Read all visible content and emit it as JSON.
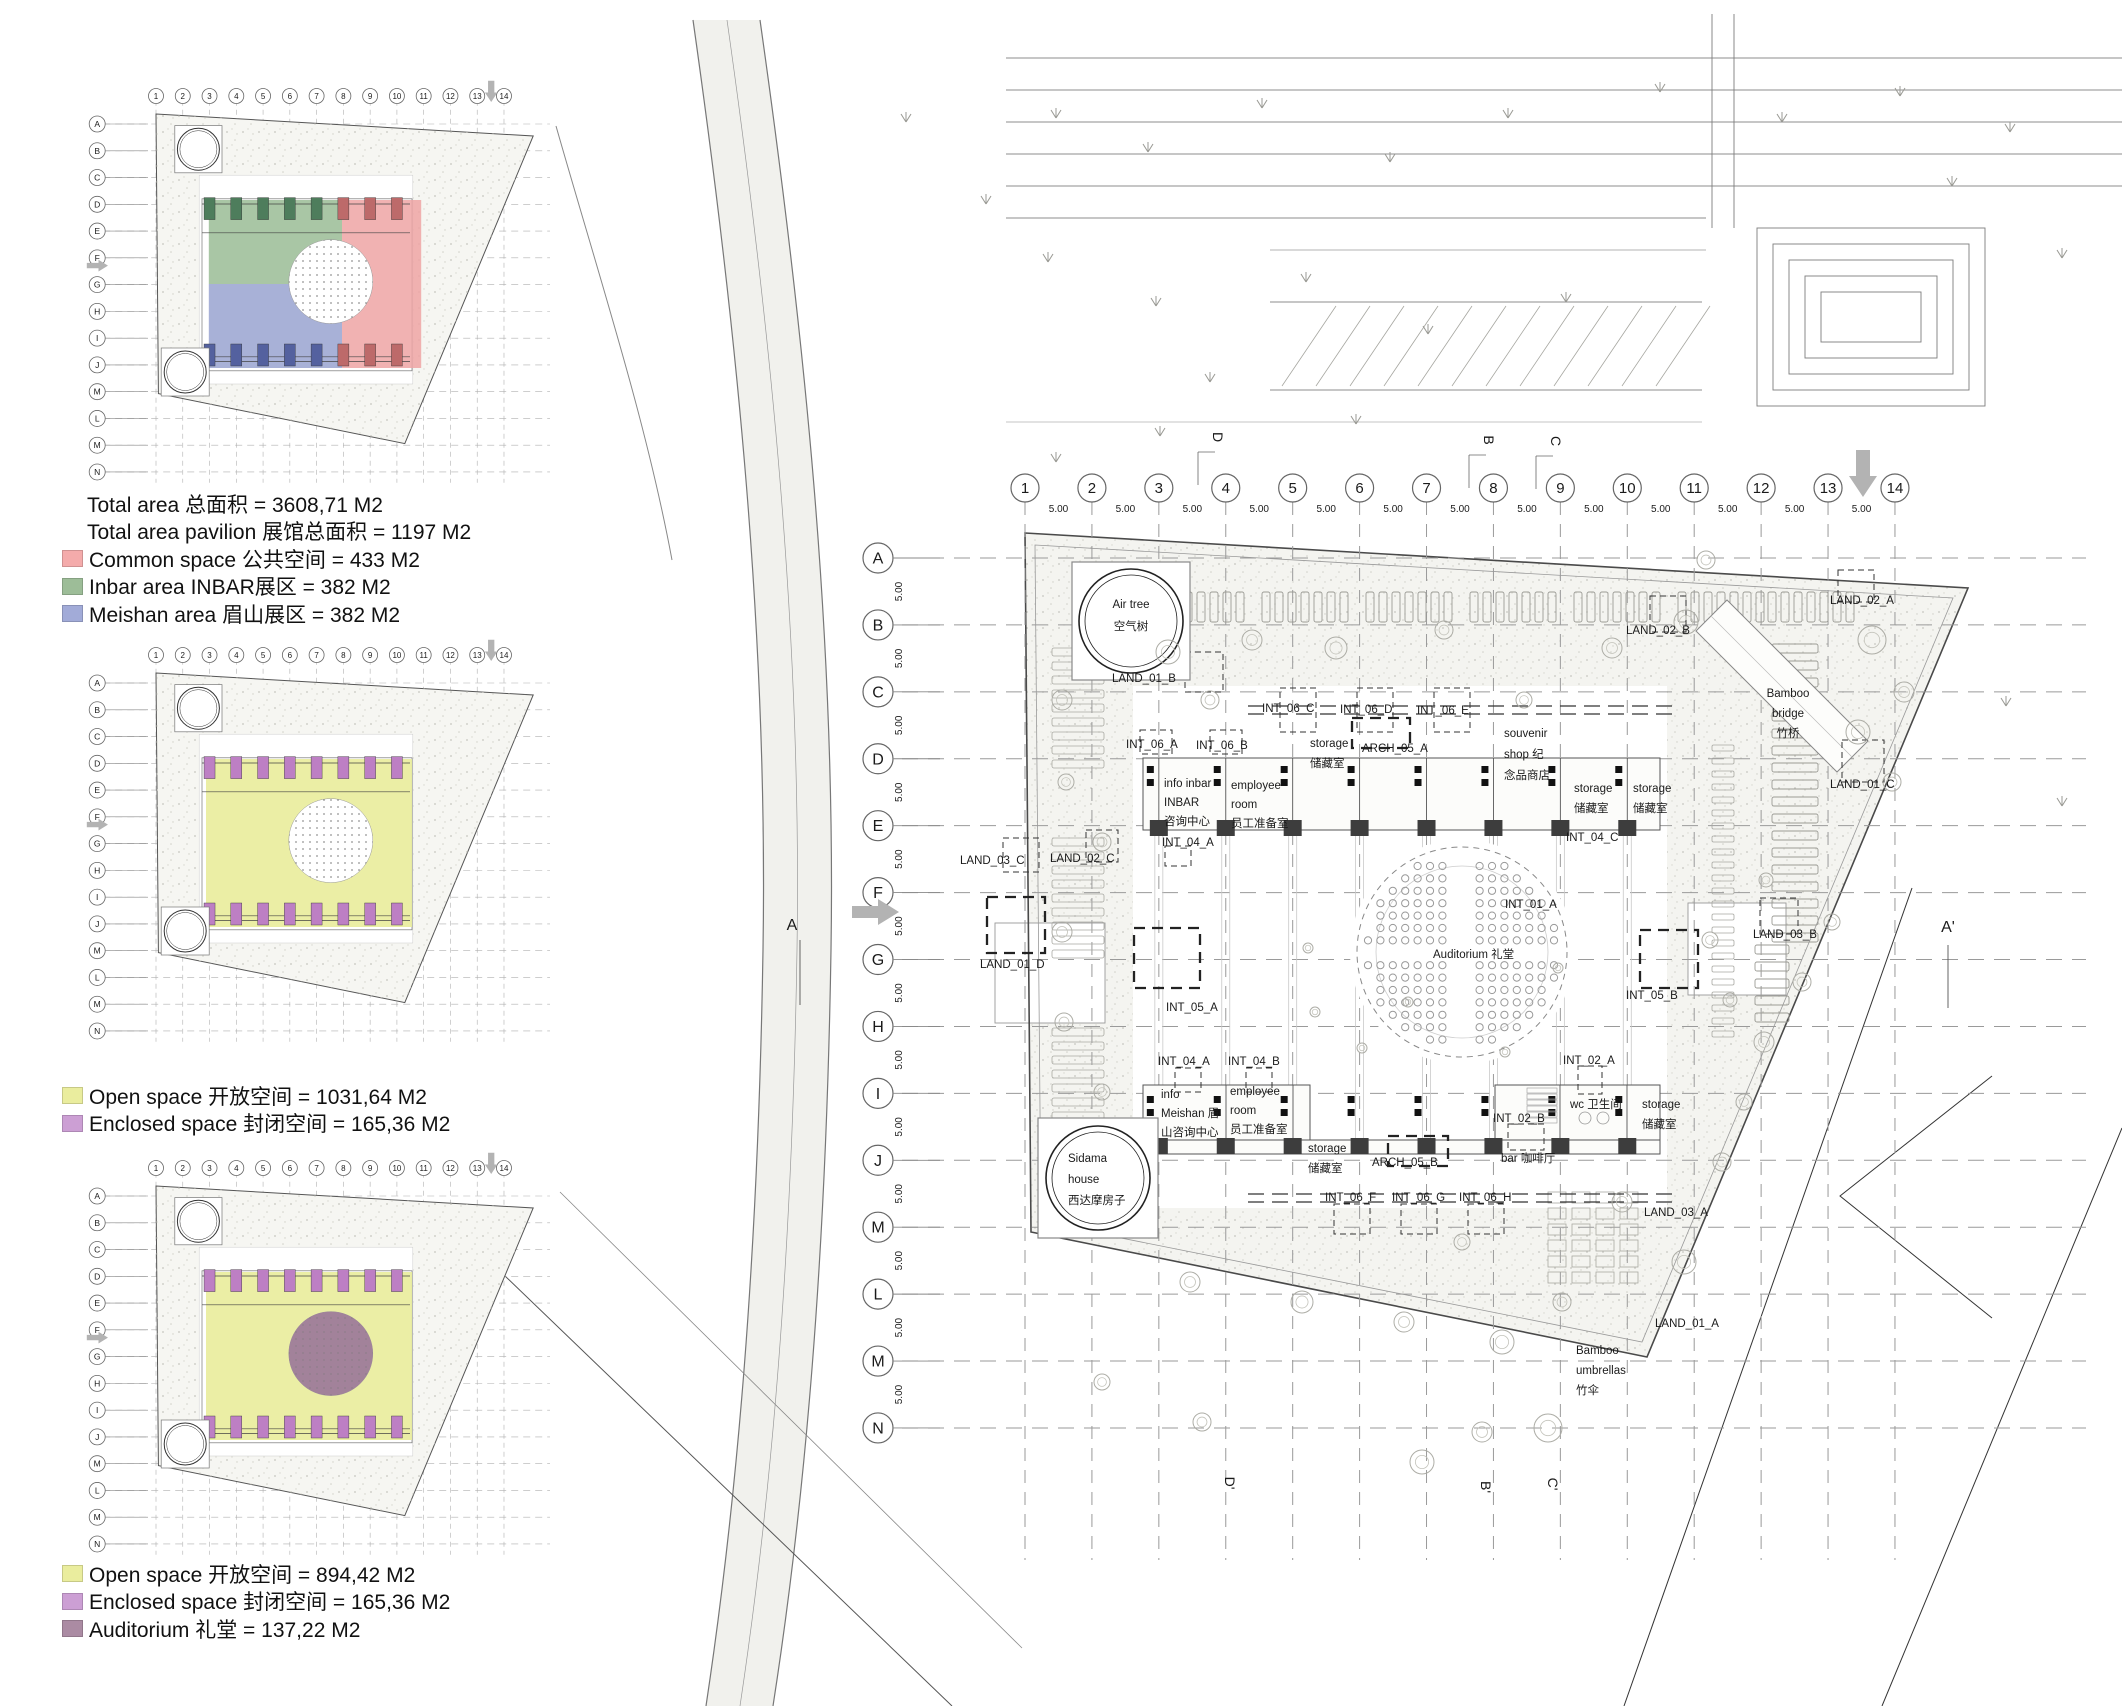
{
  "colors": {
    "common_pink": "#efa5a4",
    "inbar_green": "#9abc95",
    "meishan_blue": "#99a3d0",
    "open_yellow": "#e9ec9b",
    "enclosed_purple": "#bd7fc4",
    "auditorium_mauve": "#9d7b95",
    "swatch_pink": "#f4abab",
    "swatch_green": "#9dbd98",
    "swatch_blue": "#a2abd8",
    "swatch_yellow": "#eaed9e",
    "swatch_purple": "#cc9fd4",
    "swatch_mauve": "#ab8ba3",
    "road_gray": "#f1f1ed",
    "arrow_gray": "#b3b3b3"
  },
  "legends": [
    {
      "rows": [
        {
          "swatch": null,
          "text": "Total area 总面积 = 3608,71 M2"
        },
        {
          "swatch": null,
          "text": "Total area pavilion 展馆总面积 = 1197 M2"
        },
        {
          "swatch": "swatch_pink",
          "text": "Common space 公共空间 = 433 M2"
        },
        {
          "swatch": "swatch_green",
          "text": "Inbar area  INBAR展区 = 382 M2"
        },
        {
          "swatch": "swatch_blue",
          "text": "Meishan area 眉山展区 = 382 M2"
        }
      ]
    },
    {
      "rows": [
        {
          "swatch": "swatch_yellow",
          "text": "Open space 开放空间 = 1031,64 M2"
        },
        {
          "swatch": "swatch_purple",
          "text": "Enclosed space 封闭空间 = 165,36 M2"
        }
      ]
    },
    {
      "rows": [
        {
          "swatch": "swatch_yellow",
          "text": "Open space 开放空间 = 894,42 M2"
        },
        {
          "swatch": "swatch_purple",
          "text": "Enclosed space 封闭空间 = 165,36 M2"
        },
        {
          "swatch": "swatch_mauve",
          "text": "Auditorium 礼堂 = 137,22 M2"
        }
      ]
    }
  ],
  "grid": {
    "columns": [
      "1",
      "2",
      "3",
      "4",
      "5",
      "6",
      "7",
      "8",
      "9",
      "10",
      "11",
      "12",
      "13",
      "14"
    ],
    "rows": [
      "A",
      "B",
      "C",
      "D",
      "E",
      "F",
      "G",
      "H",
      "I",
      "J",
      "M",
      "L",
      "M",
      "N"
    ],
    "spacing_label": "5.00"
  },
  "section_markers": {
    "top": [
      "D",
      "B",
      "C"
    ],
    "bottom": [
      "D'",
      "B'",
      "C'"
    ],
    "left": "A",
    "right": "A'"
  },
  "plan_labels": [
    {
      "x": 1131,
      "y": 608,
      "a": "m",
      "lines": [
        "Air tree",
        "空气树"
      ],
      "lh": 22
    },
    {
      "x": 1112,
      "y": 682,
      "lines": [
        "LAND_01_B"
      ]
    },
    {
      "x": 1626,
      "y": 634,
      "lines": [
        "LAND_02_B"
      ]
    },
    {
      "x": 1830,
      "y": 604,
      "lines": [
        "LAND_02_A"
      ]
    },
    {
      "x": 1788,
      "y": 697,
      "a": "m",
      "lines": [
        "Bamboo",
        "bridge",
        "竹桥"
      ],
      "lh": 20
    },
    {
      "x": 1830,
      "y": 788,
      "lines": [
        "LAND_01_C"
      ]
    },
    {
      "x": 1262,
      "y": 712,
      "lines": [
        "INT_06_C"
      ]
    },
    {
      "x": 1340,
      "y": 713,
      "lines": [
        "INT_06_D"
      ]
    },
    {
      "x": 1417,
      "y": 714,
      "lines": [
        "INT_06_E"
      ]
    },
    {
      "x": 1126,
      "y": 748,
      "lines": [
        "INT_06_A"
      ]
    },
    {
      "x": 1196,
      "y": 749,
      "lines": [
        "INT_06_B"
      ]
    },
    {
      "x": 1310,
      "y": 747,
      "lines": [
        "storage",
        "储藏室"
      ],
      "lh": 20
    },
    {
      "x": 1362,
      "y": 752,
      "lines": [
        "ARCH_05_A"
      ]
    },
    {
      "x": 1504,
      "y": 737,
      "lines": [
        "souvenir",
        "shop 纪",
        "念品商店"
      ],
      "lh": 21
    },
    {
      "x": 1164,
      "y": 787,
      "lines": [
        "info inbar",
        "INBAR",
        "咨询中心"
      ],
      "lh": 19
    },
    {
      "x": 1231,
      "y": 789,
      "lines": [
        "employee",
        "room",
        "员工准备室"
      ],
      "lh": 19
    },
    {
      "x": 1162,
      "y": 846,
      "lines": [
        "INT_04_A"
      ]
    },
    {
      "x": 1574,
      "y": 792,
      "lines": [
        "storage",
        "储藏室"
      ],
      "lh": 20
    },
    {
      "x": 1633,
      "y": 792,
      "lines": [
        "storage",
        "储藏室"
      ],
      "lh": 20
    },
    {
      "x": 1566,
      "y": 841,
      "lines": [
        "INT_04_C"
      ]
    },
    {
      "x": 960,
      "y": 864,
      "lines": [
        "LAND_03_C"
      ]
    },
    {
      "x": 1050,
      "y": 862,
      "lines": [
        "LAND_02_C"
      ]
    },
    {
      "x": 980,
      "y": 968,
      "lines": [
        "LAND_01_D"
      ]
    },
    {
      "x": 1166,
      "y": 1011,
      "lines": [
        "INT_05_A"
      ]
    },
    {
      "x": 1505,
      "y": 908,
      "lines": [
        "INT_01_A"
      ]
    },
    {
      "x": 1433,
      "y": 958,
      "lines": [
        "Auditorium 礼堂"
      ]
    },
    {
      "x": 1626,
      "y": 999,
      "lines": [
        "INT_05_B"
      ]
    },
    {
      "x": 1753,
      "y": 938,
      "lines": [
        "LAND_03_B"
      ]
    },
    {
      "x": 1158,
      "y": 1065,
      "lines": [
        "INT_04_A"
      ]
    },
    {
      "x": 1228,
      "y": 1065,
      "lines": [
        "INT_04_B"
      ]
    },
    {
      "x": 1161,
      "y": 1098,
      "lines": [
        "info",
        "Meishan 眉",
        "山咨询中心"
      ],
      "lh": 19
    },
    {
      "x": 1230,
      "y": 1095,
      "lines": [
        "employee",
        "room",
        "员工准备室"
      ],
      "lh": 19
    },
    {
      "x": 1308,
      "y": 1152,
      "lines": [
        "storage",
        "储藏室"
      ],
      "lh": 20
    },
    {
      "x": 1372,
      "y": 1166,
      "lines": [
        "ARCH_05_B"
      ]
    },
    {
      "x": 1493,
      "y": 1122,
      "lines": [
        "INT_02_B"
      ]
    },
    {
      "x": 1501,
      "y": 1162,
      "lines": [
        "bar 咖啡厅"
      ]
    },
    {
      "x": 1325,
      "y": 1201,
      "lines": [
        "INT_06_F"
      ]
    },
    {
      "x": 1392,
      "y": 1201,
      "lines": [
        "INT_06_G"
      ]
    },
    {
      "x": 1459,
      "y": 1201,
      "lines": [
        "INT_06_H"
      ]
    },
    {
      "x": 1563,
      "y": 1064,
      "lines": [
        "INT_02_A"
      ]
    },
    {
      "x": 1570,
      "y": 1108,
      "lines": [
        "wc 卫生间"
      ]
    },
    {
      "x": 1642,
      "y": 1108,
      "lines": [
        "storage",
        "储藏室"
      ],
      "lh": 20
    },
    {
      "x": 1644,
      "y": 1216,
      "lines": [
        "LAND_03_A"
      ]
    },
    {
      "x": 1655,
      "y": 1327,
      "lines": [
        "LAND_01_A"
      ]
    },
    {
      "x": 1576,
      "y": 1354,
      "lines": [
        "Bamboo",
        "umbrellas",
        "竹伞"
      ],
      "lh": 20
    },
    {
      "x": 1068,
      "y": 1162,
      "lines": [
        "Sidama",
        "house",
        "西达摩房子"
      ],
      "lh": 21
    }
  ]
}
